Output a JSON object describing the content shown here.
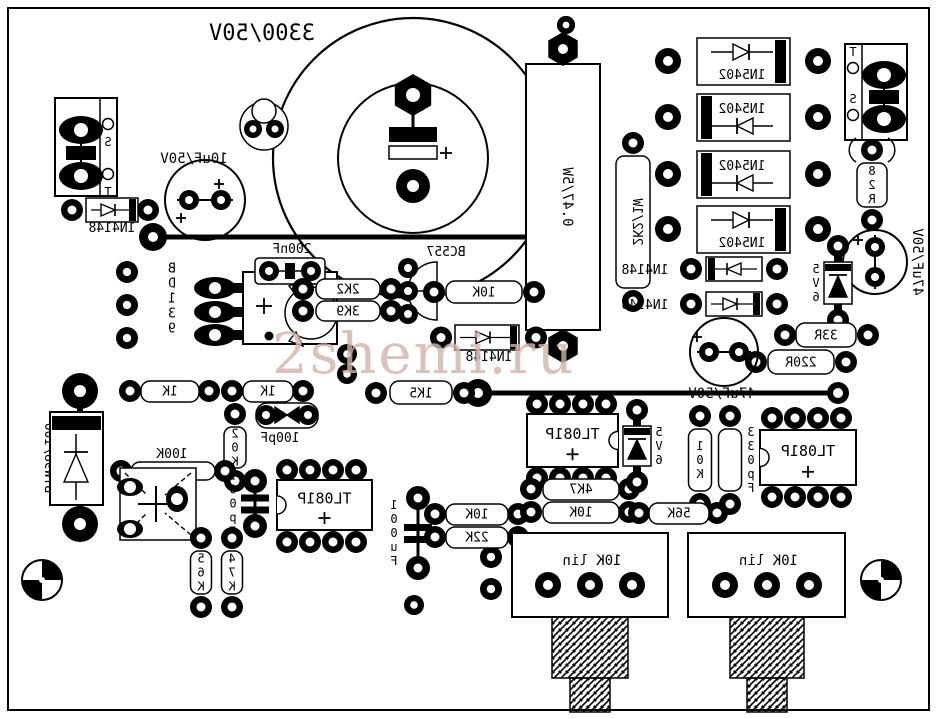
{
  "watermark": {
    "text": "2shemi.ru",
    "color": "#d2b4aa"
  },
  "board": {
    "width": 938,
    "height": 719,
    "bg": "#ffffff",
    "silk": "#000000"
  },
  "components": [
    {
      "n": "board-outline",
      "t": "border",
      "x": 8,
      "y": 8,
      "w": 921,
      "h": 702
    },
    {
      "n": "jumper-wire-1",
      "t": "line",
      "x1": 156,
      "y1": 237,
      "x2": 597,
      "y2": 237,
      "pads": [
        [
          153,
          237,
          14
        ]
      ]
    },
    {
      "n": "jumper-wire-2",
      "t": "line",
      "x1": 481,
      "y1": 393,
      "x2": 838,
      "y2": 393,
      "pads": [
        [
          478,
          393,
          14
        ],
        [
          838,
          393,
          11
        ]
      ]
    },
    {
      "n": "cap-3300uF-50V",
      "t": "bigcap",
      "cx": 413,
      "cy": 158,
      "r1": 140,
      "r2": 75,
      "label": "3300/50V",
      "lx": 262,
      "ly": 40
    },
    {
      "n": "resistor-0R47-5W",
      "t": "tallres",
      "x": 526,
      "y": 64,
      "w": 74,
      "h": 266,
      "label": "0.47/5W"
    },
    {
      "n": "resistor-2K2-1W",
      "t": "res_v",
      "x": 633,
      "pt": 143,
      "pb": 301,
      "w": 34,
      "label": "2K2/1W",
      "lm": "r"
    },
    {
      "n": "diode-1N5402-1",
      "t": "dio5402",
      "x": 697,
      "y": 38,
      "band": "r",
      "sym": "t",
      "label": "1N5402",
      "plx": 668,
      "prx": 818
    },
    {
      "n": "diode-1N5402-2",
      "t": "dio5402",
      "x": 697,
      "y": 94,
      "band": "l",
      "sym": "b",
      "label": "1N5402",
      "plx": 668,
      "prx": 818
    },
    {
      "n": "diode-1N5402-3",
      "t": "dio5402",
      "x": 697,
      "y": 151,
      "band": "l",
      "sym": "b",
      "label": "1N5402",
      "plx": 668,
      "prx": 818
    },
    {
      "n": "diode-1N5402-4",
      "t": "dio5402",
      "x": 697,
      "y": 206,
      "band": "r",
      "sym": "t",
      "label": "1N5402",
      "plx": 668,
      "prx": 818
    },
    {
      "n": "connector-left",
      "t": "conn",
      "x": 55,
      "y": 98,
      "w": 62,
      "h": 98,
      "side": "l",
      "pins": [
        "S",
        "T"
      ]
    },
    {
      "n": "connector-right",
      "t": "conn",
      "x": 845,
      "y": 44,
      "w": 62,
      "h": 96,
      "side": "r",
      "pins": [
        "T",
        "S"
      ]
    },
    {
      "n": "resistor-82R",
      "t": "res_v",
      "x": 872,
      "pt": 150,
      "pb": 220,
      "w": 30,
      "label": "82R",
      "lm": "v",
      "parens": true
    },
    {
      "n": "cap-47uF-50V-1",
      "t": "cap_circle",
      "cx": 875,
      "cy": 262,
      "r": 32,
      "pads": [
        [
          875,
          247
        ],
        [
          875,
          277
        ]
      ],
      "plus": [
        [
          858,
          240
        ]
      ],
      "label": "47uF/50V",
      "lx": 913,
      "ly": 262,
      "lmode": "r"
    },
    {
      "n": "zener-5V6-1",
      "t": "zener",
      "x": 838,
      "pt": 246,
      "pb": 320,
      "label": "5V6",
      "ldx": -22
    },
    {
      "n": "resistor-33R",
      "t": "res_h",
      "bx": 796,
      "by": 323,
      "bw": 60,
      "bh": 24,
      "plx": 785,
      "prx": 868,
      "py": 335,
      "label": "33R"
    },
    {
      "n": "resistor-220R",
      "t": "res_h",
      "bx": 768,
      "by": 350,
      "bw": 66,
      "bh": 24,
      "plx": 756,
      "prx": 846,
      "py": 362,
      "label": "220R"
    },
    {
      "n": "diode-1N4148-4",
      "t": "dio_h",
      "bx": 706,
      "by": 257,
      "bw": 56,
      "bh": 24,
      "band": "l",
      "plx": 691,
      "prx": 777,
      "label": "1N4148",
      "lx": 645,
      "ly": 274
    },
    {
      "n": "diode-1N4148-5",
      "t": "dio_h",
      "bx": 706,
      "by": 292,
      "bw": 56,
      "bh": 24,
      "band": "r",
      "plx": 691,
      "prx": 777,
      "label": "1N4148",
      "lx": 645,
      "ly": 309
    },
    {
      "n": "cap-47uF-50V-2",
      "t": "cap_circle",
      "cx": 724,
      "cy": 352,
      "r": 34,
      "pads": [
        [
          709,
          352
        ],
        [
          739,
          352
        ]
      ],
      "plus": [
        [
          697,
          337
        ]
      ],
      "label": "47uF/50V",
      "lx": 722,
      "ly": 398,
      "lmode": "h"
    },
    {
      "n": "cap-10uF-50V",
      "t": "cap_circle",
      "cx": 205,
      "cy": 200,
      "r": 40,
      "pads": [
        [
          189,
          200
        ],
        [
          221,
          200
        ]
      ],
      "plus": [
        [
          181,
          218
        ],
        [
          219,
          184
        ]
      ],
      "label": "10uF/50V",
      "lx": 194,
      "ly": 163,
      "lmode": "h"
    },
    {
      "n": "diode-1N4148-1",
      "t": "dio_h",
      "bx": 86,
      "by": 198,
      "bw": 52,
      "bh": 24,
      "band": "r",
      "plx": 72,
      "prx": 148,
      "label": "1N4148",
      "lx": 112,
      "ly": 232
    },
    {
      "n": "transistor-top",
      "t": "tcircle",
      "cx": 264,
      "cy": 126,
      "r": 24
    },
    {
      "n": "pad-column",
      "t": "pads",
      "list": [
        [
          127,
          272,
          11
        ],
        [
          127,
          305,
          11
        ],
        [
          127,
          338,
          11
        ]
      ]
    },
    {
      "n": "pads-misc",
      "t": "pads",
      "list": [
        [
          347,
          354,
          10
        ],
        [
          347,
          374,
          10
        ],
        [
          491,
          557,
          11
        ],
        [
          491,
          589,
          11
        ],
        [
          566,
          25,
          9
        ],
        [
          414,
          605,
          10
        ]
      ]
    },
    {
      "n": "transistor-BD139",
      "t": "bd139",
      "label": "BD139"
    },
    {
      "n": "cap-200nF",
      "t": "cap_film",
      "bx": 255,
      "by": 258,
      "bw": 70,
      "bh": 26,
      "plx": 269,
      "prx": 311,
      "py": 271,
      "label": "200nF",
      "lx": 292,
      "ly": 253
    },
    {
      "n": "resistor-2K2",
      "t": "res_h",
      "bx": 316,
      "by": 279,
      "bw": 64,
      "bh": 20,
      "plx": 303,
      "prx": 391,
      "py": 289,
      "label": "2K2"
    },
    {
      "n": "resistor-3K9",
      "t": "res_h",
      "bx": 316,
      "by": 301,
      "bw": 64,
      "bh": 20,
      "plx": 303,
      "prx": 391,
      "py": 311,
      "label": "3K9"
    },
    {
      "n": "transistor-BC557",
      "t": "bc557",
      "label": "BC557"
    },
    {
      "n": "resistor-10K-1",
      "t": "res_h",
      "bx": 446,
      "by": 281,
      "bw": 76,
      "bh": 22,
      "plx": 434,
      "prx": 534,
      "py": 292,
      "label": "10K"
    },
    {
      "n": "diode-1N4148-3",
      "t": "dio_h",
      "bx": 455,
      "by": 325,
      "bw": 64,
      "bh": 25,
      "band": "r",
      "plx": 441,
      "prx": 536,
      "label": "1N4148",
      "lx": 489,
      "ly": 361
    },
    {
      "n": "diode-BYW98-100",
      "t": "byw",
      "label": "BYW98/100"
    },
    {
      "n": "resistor-1K-1",
      "t": "res_h",
      "bx": 141,
      "by": 381,
      "bw": 58,
      "bh": 21,
      "plx": 130,
      "prx": 209,
      "py": 391,
      "label": "1K"
    },
    {
      "n": "resistor-1K-2",
      "t": "res_h",
      "bx": 243,
      "by": 381,
      "bw": 50,
      "bh": 21,
      "plx": 232,
      "prx": 303,
      "py": 391,
      "label": "1K"
    },
    {
      "n": "resistor-1K5",
      "t": "res_h",
      "bx": 390,
      "by": 381,
      "bw": 62,
      "bh": 23,
      "plx": 376,
      "prx": 464,
      "py": 393,
      "label": "1K5"
    },
    {
      "n": "resistor-20K",
      "t": "res_v",
      "x": 235,
      "pt": 414,
      "pb": 481,
      "w": 22,
      "label": "20K",
      "lm": "v"
    },
    {
      "n": "cap-100pF-1",
      "t": "cap_bow",
      "bx": 256,
      "by": 403,
      "bw": 62,
      "bh": 25,
      "plx": 266,
      "prx": 308,
      "py": 415,
      "label": "100pF",
      "lx": 280,
      "ly": 442
    },
    {
      "n": "cap-100pF-2",
      "t": "cap_vbar",
      "x": 255,
      "pt": 481,
      "pb": 526,
      "label": "100pF",
      "ldx": -22
    },
    {
      "n": "resistor-100K",
      "t": "res_h",
      "bx": 131,
      "by": 462,
      "bw": 84,
      "bh": 18,
      "plx": 121,
      "prx": 225,
      "py": 471,
      "label": "100K",
      "lpos": "above",
      "lx": 172,
      "ly": 458
    },
    {
      "n": "trimmer",
      "t": "trim"
    },
    {
      "n": "resistor-56K-1",
      "t": "res_v",
      "x": 201,
      "pt": 538,
      "pb": 607,
      "w": 21,
      "label": "56K",
      "lm": "v"
    },
    {
      "n": "resistor-47K",
      "t": "res_v",
      "x": 232,
      "pt": 538,
      "pb": 607,
      "w": 21,
      "label": "47K",
      "lm": "v"
    },
    {
      "n": "ic-TL081P-1",
      "t": "ic",
      "x": 277,
      "y": 480,
      "w": 95,
      "h": 50,
      "notch": "l",
      "pty": 470,
      "pby": 542,
      "pxs": [
        287,
        310,
        333,
        356
      ],
      "label": "TL081P"
    },
    {
      "n": "cap-100uF",
      "t": "cap_vbar",
      "x": 418,
      "pt": 498,
      "pb": 568,
      "label": "100uF",
      "ldx": -24
    },
    {
      "n": "resistor-10K-2",
      "t": "res_h",
      "bx": 446,
      "by": 504,
      "bw": 62,
      "bh": 21,
      "plx": 435,
      "prx": 518,
      "py": 514,
      "label": "10K"
    },
    {
      "n": "resistor-22K",
      "t": "res_h",
      "bx": 446,
      "by": 527,
      "bw": 62,
      "bh": 21,
      "plx": 435,
      "prx": 518,
      "py": 537,
      "label": "22K"
    },
    {
      "n": "ic-TL081P-2",
      "t": "ic",
      "x": 527,
      "y": 414,
      "w": 91,
      "h": 53,
      "notch": "r",
      "pty": 404,
      "pby": 478,
      "pxs": [
        537,
        560,
        583,
        606
      ],
      "label": "TL081P"
    },
    {
      "n": "resistor-4K7",
      "t": "res_h",
      "bx": 543,
      "by": 479,
      "bw": 76,
      "bh": 21,
      "plx": 531,
      "prx": 629,
      "py": 489,
      "label": "4K7"
    },
    {
      "n": "resistor-10K-3",
      "t": "res_h",
      "bx": 543,
      "by": 502,
      "bw": 76,
      "bh": 21,
      "plx": 531,
      "prx": 629,
      "py": 512,
      "label": "10K"
    },
    {
      "n": "zener-5V6-2",
      "t": "zener",
      "x": 637,
      "pt": 410,
      "pb": 482,
      "label": "5V6",
      "ldx": 22
    },
    {
      "n": "resistor-10K-4",
      "t": "res_v",
      "x": 700,
      "pt": 416,
      "pb": 504,
      "w": 23,
      "label": "10K",
      "lm": "v"
    },
    {
      "n": "cap-330pF",
      "t": "res_v",
      "x": 730,
      "pt": 416,
      "pb": 504,
      "w": 23,
      "label": "330pF",
      "lm": "v",
      "ldx": 21
    },
    {
      "n": "resistor-56K-2",
      "t": "res_h",
      "bx": 649,
      "by": 503,
      "bw": 60,
      "bh": 21,
      "plx": 639,
      "prx": 717,
      "py": 513,
      "label": "56K"
    },
    {
      "n": "ic-TL081P-3",
      "t": "ic",
      "x": 760,
      "y": 430,
      "w": 96,
      "h": 55,
      "notch": "l",
      "pty": 418,
      "pby": 497,
      "pxs": [
        772,
        795,
        818,
        841
      ],
      "label": "TL081P"
    },
    {
      "n": "pot-10K-lin-1",
      "t": "pot",
      "x": 512,
      "y": 533,
      "w": 156,
      "h": 84,
      "pxs": [
        548,
        590,
        632
      ],
      "label": "10K lin",
      "shaft": [
        552,
        617,
        76,
        61
      ],
      "stem": [
        570,
        678,
        40,
        34
      ]
    },
    {
      "n": "pot-10K-lin-2",
      "t": "pot",
      "x": 688,
      "y": 533,
      "w": 157,
      "h": 84,
      "pxs": [
        725,
        767,
        809
      ],
      "label": "10K lin",
      "shaft": [
        730,
        617,
        74,
        61
      ],
      "stem": [
        747,
        678,
        40,
        34
      ]
    },
    {
      "n": "fiducial-bottom-left",
      "t": "fid",
      "x": 42,
      "y": 580,
      "r": 20
    },
    {
      "n": "fiducial-bottom-right",
      "t": "fid",
      "x": 881,
      "y": 580,
      "r": 20
    }
  ]
}
